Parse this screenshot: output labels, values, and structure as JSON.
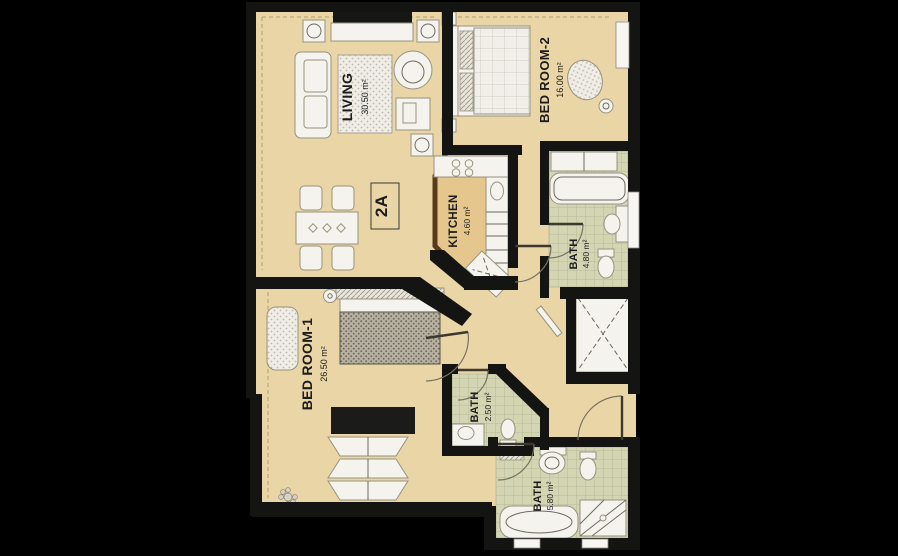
{
  "unit": {
    "label": "2A"
  },
  "rooms": [
    {
      "name": "LIVING",
      "area": "30.50 m²"
    },
    {
      "name": "BED ROOM-2",
      "area": "16.00 m²"
    },
    {
      "name": "KITCHEN",
      "area": "4.60 m²"
    },
    {
      "name": "BATH",
      "area": "4.80 m²"
    },
    {
      "name": "BATH",
      "area": "2.50 m²"
    },
    {
      "name": "BATH",
      "area": "5.80 m²"
    },
    {
      "name": "BED ROOM-1",
      "area": "26.50 m²"
    }
  ],
  "colors": {
    "background": "#000000",
    "floor": "#e9d5a6",
    "wall": "#141412",
    "bath_tile": "#d3d5b3",
    "kitchen_floor": "#e5c78e",
    "kitchen_outline": "#5a3a1b",
    "furniture": "#f4f3ee",
    "label_text": "#1c1c1c"
  }
}
